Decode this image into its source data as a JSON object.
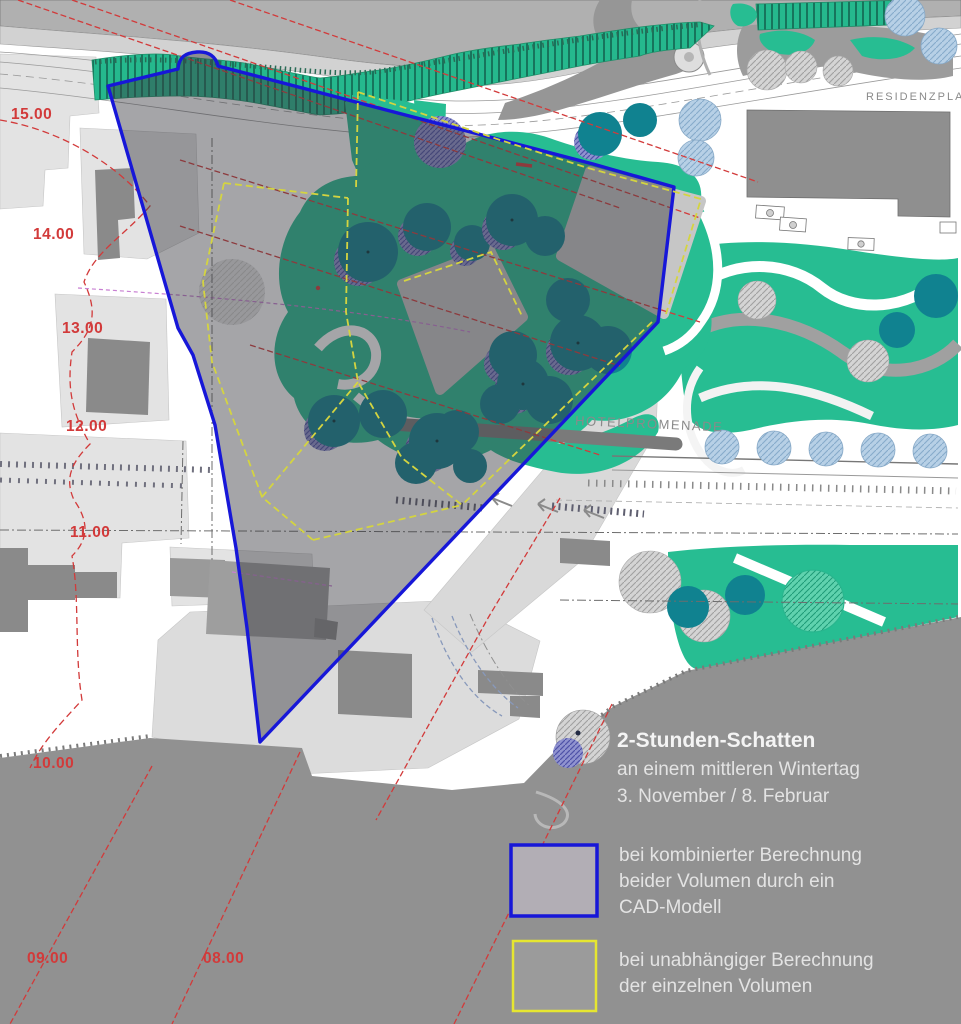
{
  "map": {
    "labels": {
      "hotelpromenade": "HOTELPROMENADE",
      "residenzplatz": "RESIDENZPLATZ"
    },
    "contours": [
      {
        "label": "15.00"
      },
      {
        "label": "14.00"
      },
      {
        "label": "13.00"
      },
      {
        "label": "12.00"
      },
      {
        "label": "11.00"
      },
      {
        "label": "10.00"
      },
      {
        "label": "09.00"
      },
      {
        "label": "08.00"
      }
    ]
  },
  "legend": {
    "title": "2-Stunden-Schatten",
    "subtitle1": "an einem mittleren Wintertag",
    "subtitle2": "3. November / 8. Februar",
    "combined": {
      "line1": "bei kombinierter Berechnung",
      "line2": "beider Volumen durch ein",
      "line3": "CAD-Modell"
    },
    "independent": {
      "line1": "bei unabhängiger Berechnung",
      "line2": "der einzelnen Volumen"
    }
  },
  "colors": {
    "combined_outline": "#1717d8",
    "independent_outline": "#d4d440",
    "legend_yellow": "#e6e630",
    "shadow_fill": "rgba(58,58,66,0.46)",
    "vegetation_green": "#27bd92",
    "tree_teal": "#108290",
    "contour_red": "#d23a3a",
    "slope_gray": "#919191",
    "legend_combined_swatch_fill": "#b2aeb5"
  }
}
